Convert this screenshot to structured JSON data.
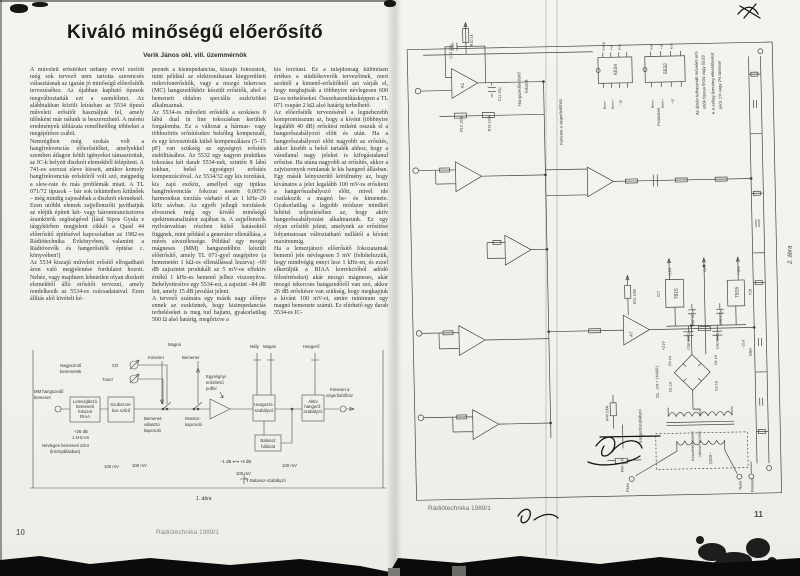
{
  "scan": {
    "paper_color": "#f3f2ed",
    "ink_color": "#32312c"
  },
  "left_page": {
    "title": "Kiváló minőségű előerősítő",
    "author": "Verik János okl. vill. üzemmérnök",
    "columns": [
      "A műveleti erősítőket néhány évvel ezelőtt még sok tervező nem tartotta szerencsés választásnak az igazán jó minőségű előerősítők tervezéséhez. Az újabban kapható típusok megváltoztatták ezt a szemléletet. Az alábbiakban közölt leírásban az 5534 típusú műveleti erősítőt használjuk fel, amely időnként már nálunk is beszerezhető. A mérési eredmények táblázata remélhetőleg többeket a megépítésre csábít.\nNemrégiben még szokás volt a hangfrekvenciás előerősítőket, amelyekkel szemben átlagon felüli igényeket támasztottak, az IC-k helyett diszkrét elemekből felépíteni. A 741-es sorozat eleve kiesett, amikor komoly hangfrekvenciás erősítőről volt szó, mégpedig a slew-rate és más problémák miatt. A TL 071/72 típusok – bár sok tekintetben kitűnőek – még mindig zajosabbak a diszkrét elemeknél. Ezen utóbbi elemek zajjellemzőit javíthatjuk az eléjük épített két- vagy háromtranzisztoros áramkörök segítségével (lásd Sipos Gyula e tárgykörben megjelent cikkét a Quad 44 előerősítő építésével kapcsolatban az 1982-es Rádiótechnika Évkönyvben, valamint a Rádióvevők és hangerősítők építése c. könyvében!)\nAz 5534 kiszajú műveleti erősítő elfogadható áron való megjelenése fordulatot hozott. Nehéz, vagy majdnem lehetetlen olyan diszkrét elemekből álló erősítőt tervezni, amely rendelkezik az 5534-es csúcsadataival. Ezen állítás alól kivételt ké-",
      "peznek a kisimpedanciás, kiszajú fokozatok, mint például az elektronikusan kiegyenlített mikrofonerősítők, vagy a mozgó tekercses (MC) hangszedőkhöz készült erősítők, ahol a bemeneti oldalon speciális eszközöket alkalmaznak.\nAz 5534-es műveleti erősítők a szokásos 8 lábú dual in line tokozásban kerültek forgalomba. Ez a változat a hármas- vagy többszörös erősítésekre belsőleg kompenzált, és egy kivezetésük külső kompenzálásra (5–15 pF) van szükség az egységnyi erősítés stabilitásához. Az 5532 egy nagyon praktikus tokozása két darab 5534-nek, szintén 8 lábú tokban, belső egységnyi erősítés kompenzációval. Az 5534/32 egy kis torzítású, kis zajú eszköz, amellyel egy tipikus hangfrekvenciás fokozat esetén 0,005% harmonikus torzítás várható el az 1 kHz–20 kHz sávban. Az egyéb jellegű torzítások elvesznek még egy kiváló minőségű spektrumanalizátor zajában is. A zajjellemzők nyilvánvalóan részben külső hatásoktól függnek, mint például a generátor ellenállása, a mérés sávszélessége. Például egy mozgó mágneses (MM) hangszedőhöz készült előerősítő, amely TL 071-gyel megépítve (a bemenetén 1 kΩ-os ellenállással lezárva) –69 dB zajszintet produkált az 5 mV-os effektív értékű 1 kHz-es bemenő jelhez viszonyítva. Behelyettesítve egy 5534-est, a zajszint –84 dB lett, amely 15 dB javulást jelent.\nA tervező számára egy másik nagy előnye ennek az eszköznek, hogy kisimpedanciás terheléseket is meg tud hajtani, gyakorlatilag 500 Ω alsó határig, megőrizve a",
      "kis torzítást. Ez a tulajdonság különösen értékes a stúdiókeverők tervezőinek, mert azoktól a kimenő-erősítőktől azt várják el, hogy meghajtsák a többnyire névlegesen 600 Ω-os terheléseket. Összehasonlításképpen a TL 071 csupán 2 kΩ alsó határig terhelhető.\nAz előerősítők tervezésénél a legnehezebb kompromisszum az, hogy a kívánt (többnyire legalább 40 dB) erősítést miként osszuk el a hangerőszabályozó előtt és után. Ha a hangerőszabályozó előtt nagyobb az erősítés, akkor kisebb a belső tartalék ahhoz, hogy a váratlanul nagy jeleket is kifogástalanul erősítse. Ha utána nagyobb az erősítés, akkor a zajviszonyok romlanak le kis hangerő állásban. Egy másik kényszerítő körülmény az, hogy kívánatos a jelet legalább 100 mV-ra erősíteni a hangerőszabályozó előtt, mivel ide csatlakozik a magnó be- és kimenete. Gyakorlatilag a legjobb módszer mindkét feltétel teljesítéséhez az, hogy aktív hangerőszabályozást alkalmazunk. Ez egy olyan erősítőt jelent, amelynek az erősítése folyamatosan változtatható nullától a kívánt maximumig.\nHa a lemezjátszó előerősítő fokozatainak bemenő jele névlegesen 5 mV (feltételezzük, hogy mindvégig ennyi lesz 1 kHz-en, és ezzel elkerüljük a RIAA korrekcióból adódó félreértéseket) akár mozgó mágneses, akár mozgó tekercses hangszedőről van szó, akkor 26 dB erősítésre van szükség, hogy megkapjuk a kívánt 100 mV-ot, amire minimum egy magnó bemenete számít. Ez elérhető egy darab 5534-es IC-"
    ],
    "figure1": {
      "caption": "1. ábra",
      "labels": [
        {
          "t": "Magnó",
          "x": 138,
          "y": 6
        },
        {
          "t": "Kimenet",
          "x": 118,
          "y": 19
        },
        {
          "t": "Bemenet",
          "x": 152,
          "y": 19
        },
        {
          "t": "Mély",
          "x": 220,
          "y": 8
        },
        {
          "t": "Magas",
          "x": 233,
          "y": 8
        },
        {
          "t": "Hangerő",
          "x": 273,
          "y": 8
        },
        {
          "t": "Nagyszintű",
          "x": 30,
          "y": 27
        },
        {
          "t": "bemenetek",
          "x": 30,
          "y": 33
        },
        {
          "t": "CD",
          "x": 82,
          "y": 27
        },
        {
          "t": "Tuner",
          "x": 72,
          "y": 41
        },
        {
          "t": "MM hangszedő",
          "x": 4,
          "y": 53
        },
        {
          "t": "bemenet",
          "x": 4,
          "y": 59
        },
        {
          "t": "Lemezjátszó",
          "x": 55,
          "y": 63,
          "a": "middle"
        },
        {
          "t": "bemeneti",
          "x": 55,
          "y": 68,
          "a": "middle"
        },
        {
          "t": "fokozat",
          "x": 55,
          "y": 73,
          "a": "middle"
        },
        {
          "t": "RIAA",
          "x": 55,
          "y": 78,
          "a": "middle"
        },
        {
          "t": "Szubszoni-",
          "x": 91,
          "y": 66,
          "a": "middle"
        },
        {
          "t": "kus szűrő",
          "x": 91,
          "y": 72,
          "a": "middle"
        },
        {
          "t": "Bemenet-",
          "x": 114,
          "y": 80
        },
        {
          "t": "választó",
          "x": 114,
          "y": 86
        },
        {
          "t": "kapcsoló",
          "x": 114,
          "y": 92
        },
        {
          "t": "Monitor-",
          "x": 155,
          "y": 80
        },
        {
          "t": "kapcsoló",
          "x": 155,
          "y": 86
        },
        {
          "t": "Egységnyi",
          "x": 176,
          "y": 38
        },
        {
          "t": "erősítésű",
          "x": 176,
          "y": 44
        },
        {
          "t": "puffer",
          "x": 176,
          "y": 50
        },
        {
          "t": "Hangszín-",
          "x": 234,
          "y": 66,
          "a": "middle"
        },
        {
          "t": "szabályzó",
          "x": 234,
          "y": 72,
          "a": "middle"
        },
        {
          "t": "Aktív",
          "x": 283,
          "y": 63,
          "a": "middle"
        },
        {
          "t": "hangerő-",
          "x": 283,
          "y": 68,
          "a": "middle"
        },
        {
          "t": "szabályzó",
          "x": 283,
          "y": 73,
          "a": "middle"
        },
        {
          "t": "Balansz",
          "x": 238,
          "y": 102,
          "a": "middle"
        },
        {
          "t": "hálózat",
          "x": 238,
          "y": 108,
          "a": "middle"
        },
        {
          "t": "Kimenet a",
          "x": 300,
          "y": 51
        },
        {
          "t": "végerősítőhöz",
          "x": 296,
          "y": 57
        },
        {
          "t": "+26 dB",
          "x": 44,
          "y": 93
        },
        {
          "t": "1 kHz-en",
          "x": 42,
          "y": 99
        },
        {
          "t": "Névleges bemeneti szint",
          "x": 12,
          "y": 107
        },
        {
          "t": "(középállásban)",
          "x": 20,
          "y": 113
        },
        {
          "t": "100 mV",
          "x": 74,
          "y": 128
        },
        {
          "t": "100 mV",
          "x": 102,
          "y": 127
        },
        {
          "t": "−1 dB ⟷ +3 dB",
          "x": 190,
          "y": 123
        },
        {
          "t": "100 mV",
          "x": 206,
          "y": 135
        },
        {
          "t": "100 mV",
          "x": 252,
          "y": 127
        },
        {
          "t": "Balansz-szabályzó",
          "x": 220,
          "y": 142
        },
        {
          "t": "1. ábra",
          "x": 166,
          "y": 160,
          "i": 1,
          "s": 5
        }
      ]
    },
    "footer": {
      "page_number": "10",
      "journal": "Rádiótechnika 1989/1"
    }
  },
  "right_page": {
    "figure2": {
      "caption": "2. ábra",
      "labels": [
        {
          "t": "A1",
          "x": 70,
          "y": 86,
          "r": -90,
          "s": 4.5
        },
        {
          "t": "R10 1k",
          "x": 80,
          "y": 44,
          "r": -90,
          "s": 3.8
        },
        {
          "t": "C10 22p",
          "x": 59,
          "y": 56,
          "r": -90,
          "s": 3.8
        },
        {
          "t": "C11 22p",
          "x": 107,
          "y": 100,
          "r": -90,
          "s": 3.8
        },
        {
          "t": "R15 100k",
          "x": 68,
          "y": 130,
          "r": -90,
          "s": 3.8
        },
        {
          "t": "R16 100k",
          "x": 96,
          "y": 130,
          "r": -90,
          "s": 3.8
        },
        {
          "t": "Hangszedőerősítő",
          "x": 127,
          "y": 105,
          "r": -90,
          "s": 4.2
        },
        {
          "t": "fokozat",
          "x": 134,
          "y": 92,
          "r": -90,
          "s": 4.2
        },
        {
          "t": "Kimenet a végerősítőhöz",
          "x": 168,
          "y": 145,
          "r": -90,
          "s": 4.2
        },
        {
          "t": "5534",
          "x": 224,
          "y": 76,
          "r": -90,
          "s": 5
        },
        {
          "t": "5532",
          "x": 274,
          "y": 76,
          "r": -90,
          "s": 5
        },
        {
          "t": "Komp",
          "x": 212,
          "y": 51,
          "r": -90,
          "s": 3.4
        },
        {
          "t": "+Ut",
          "x": 220,
          "y": 51,
          "r": -90,
          "s": 3.4
        },
        {
          "t": "Kim",
          "x": 228,
          "y": 51,
          "r": -90,
          "s": 3.4
        },
        {
          "t": "Bem−",
          "x": 212,
          "y": 101,
          "r": -90,
          "s": 3.4,
          "a": "end"
        },
        {
          "t": "Bem+",
          "x": 220,
          "y": 101,
          "r": -90,
          "s": 3.4,
          "a": "end"
        },
        {
          "t": "−Ut",
          "x": 228,
          "y": 101,
          "r": -90,
          "s": 3.4,
          "a": "end"
        },
        {
          "t": "Kim",
          "x": 260,
          "y": 51,
          "r": -90,
          "s": 3.4
        },
        {
          "t": "+Ut",
          "x": 270,
          "y": 51,
          "r": -90,
          "s": 3.4
        },
        {
          "t": "Kim",
          "x": 280,
          "y": 51,
          "r": -90,
          "s": 3.4
        },
        {
          "t": "Bem−",
          "x": 260,
          "y": 101,
          "r": -90,
          "s": 3.4,
          "a": "end"
        },
        {
          "t": "Bem+",
          "x": 270,
          "y": 101,
          "r": -90,
          "s": 3.4,
          "a": "end"
        },
        {
          "t": "−Ut",
          "x": 280,
          "y": 101,
          "r": -90,
          "s": 3.4,
          "a": "end"
        },
        {
          "t": "Felülnézet",
          "x": 266,
          "y": 128,
          "r": -90,
          "s": 4
        },
        {
          "t": "Az ábrán felhasznált műveleti erő-",
          "x": 305,
          "y": 118,
          "r": -90,
          "s": 4.3
        },
        {
          "t": "sítők típusa 5534 vagy 5532!",
          "x": 312,
          "y": 112,
          "r": -90,
          "s": 4.3
        },
        {
          "t": "∗ A csillag fémréteg ellenállásokat",
          "x": 321,
          "y": 118,
          "r": -90,
          "s": 4.1
        },
        {
          "t": "jelöl, 1% vagy 2% tűréssel",
          "x": 328,
          "y": 112,
          "r": -90,
          "s": 4.1
        },
        {
          "t": "IC7",
          "x": 262,
          "y": 300,
          "r": -90,
          "s": 3.8
        },
        {
          "t": "7815",
          "x": 280,
          "y": 303,
          "r": -90,
          "s": 5
        },
        {
          "t": "7915",
          "x": 341,
          "y": 303,
          "r": -90,
          "s": 5
        },
        {
          "t": "IC8",
          "x": 354,
          "y": 300,
          "r": -90,
          "s": 3.8
        },
        {
          "t": "+15V",
          "x": 274,
          "y": 280,
          "r": -90,
          "s": 3.8
        },
        {
          "t": "0V",
          "x": 309,
          "y": 276,
          "r": -90,
          "s": 3.8
        },
        {
          "t": "−15V",
          "x": 343,
          "y": 280,
          "r": -90,
          "s": 3.8
        },
        {
          "t": "C57 470n",
          "x": 296,
          "y": 330,
          "r": -90,
          "s": 3.6
        },
        {
          "t": "C59 470n",
          "x": 324,
          "y": 330,
          "r": -90,
          "s": 3.6
        },
        {
          "t": "C58 2200µ",
          "x": 291,
          "y": 354,
          "r": -90,
          "s": 3.6
        },
        {
          "t": "C60 2200µ",
          "x": 320,
          "y": 354,
          "r": -90,
          "s": 3.6
        },
        {
          "t": "+21V",
          "x": 266,
          "y": 354,
          "r": -90,
          "s": 3.8
        },
        {
          "t": "−21V",
          "x": 346,
          "y": 354,
          "r": -90,
          "s": 3.8
        },
        {
          "t": "GND",
          "x": 353,
          "y": 362,
          "r": -90,
          "s": 3.8
        },
        {
          "t": "D3 1A",
          "x": 272,
          "y": 370,
          "r": -90,
          "s": 3.6
        },
        {
          "t": "D4 1A",
          "x": 318,
          "y": 370,
          "r": -90,
          "s": 3.6
        },
        {
          "t": "D1 1A",
          "x": 272,
          "y": 396,
          "r": -90,
          "s": 3.6
        },
        {
          "t": "D2 1A",
          "x": 318,
          "y": 396,
          "r": -90,
          "s": 3.6
        },
        {
          "t": "D1…D4 = 1N4001",
          "x": 259,
          "y": 402,
          "r": -90,
          "s": 4
        },
        {
          "t": "Készülékbe épített",
          "x": 293,
          "y": 466,
          "r": -90,
          "s": 3.6
        },
        {
          "t": "hálózati vezeték",
          "x": 300,
          "y": 462,
          "r": -90,
          "s": 3.6
        },
        {
          "t": "220V~",
          "x": 311,
          "y": 470,
          "r": -90,
          "s": 4.2
        },
        {
          "t": "Fázis",
          "x": 227,
          "y": 496,
          "r": -90,
          "s": 3.8
        },
        {
          "t": "Nulla",
          "x": 340,
          "y": 496,
          "r": -90,
          "s": 3.8
        },
        {
          "t": "Földelés",
          "x": 352,
          "y": 499,
          "r": -90,
          "s": 3.8
        },
        {
          "t": "hangerőszabályzó",
          "x": 241,
          "y": 447,
          "r": -90,
          "s": 4.2
        },
        {
          "t": "R25 100k",
          "x": 238,
          "y": 307,
          "r": -90,
          "s": 3.6
        },
        {
          "t": "R49 100k",
          "x": 208,
          "y": 424,
          "r": -90,
          "s": 3.6
        },
        {
          "t": "R50 2,2k",
          "x": 222,
          "y": 476,
          "r": -90,
          "s": 3.6
        },
        {
          "t": "A7",
          "x": 234,
          "y": 340,
          "r": -90,
          "s": 4.5
        },
        {
          "t": "2. ábra",
          "x": 395,
          "y": 270,
          "r": -90,
          "s": 6,
          "i": 1
        }
      ]
    },
    "footer": {
      "journal": "Rádiótechnika 1989/1",
      "page_number": "11"
    }
  }
}
